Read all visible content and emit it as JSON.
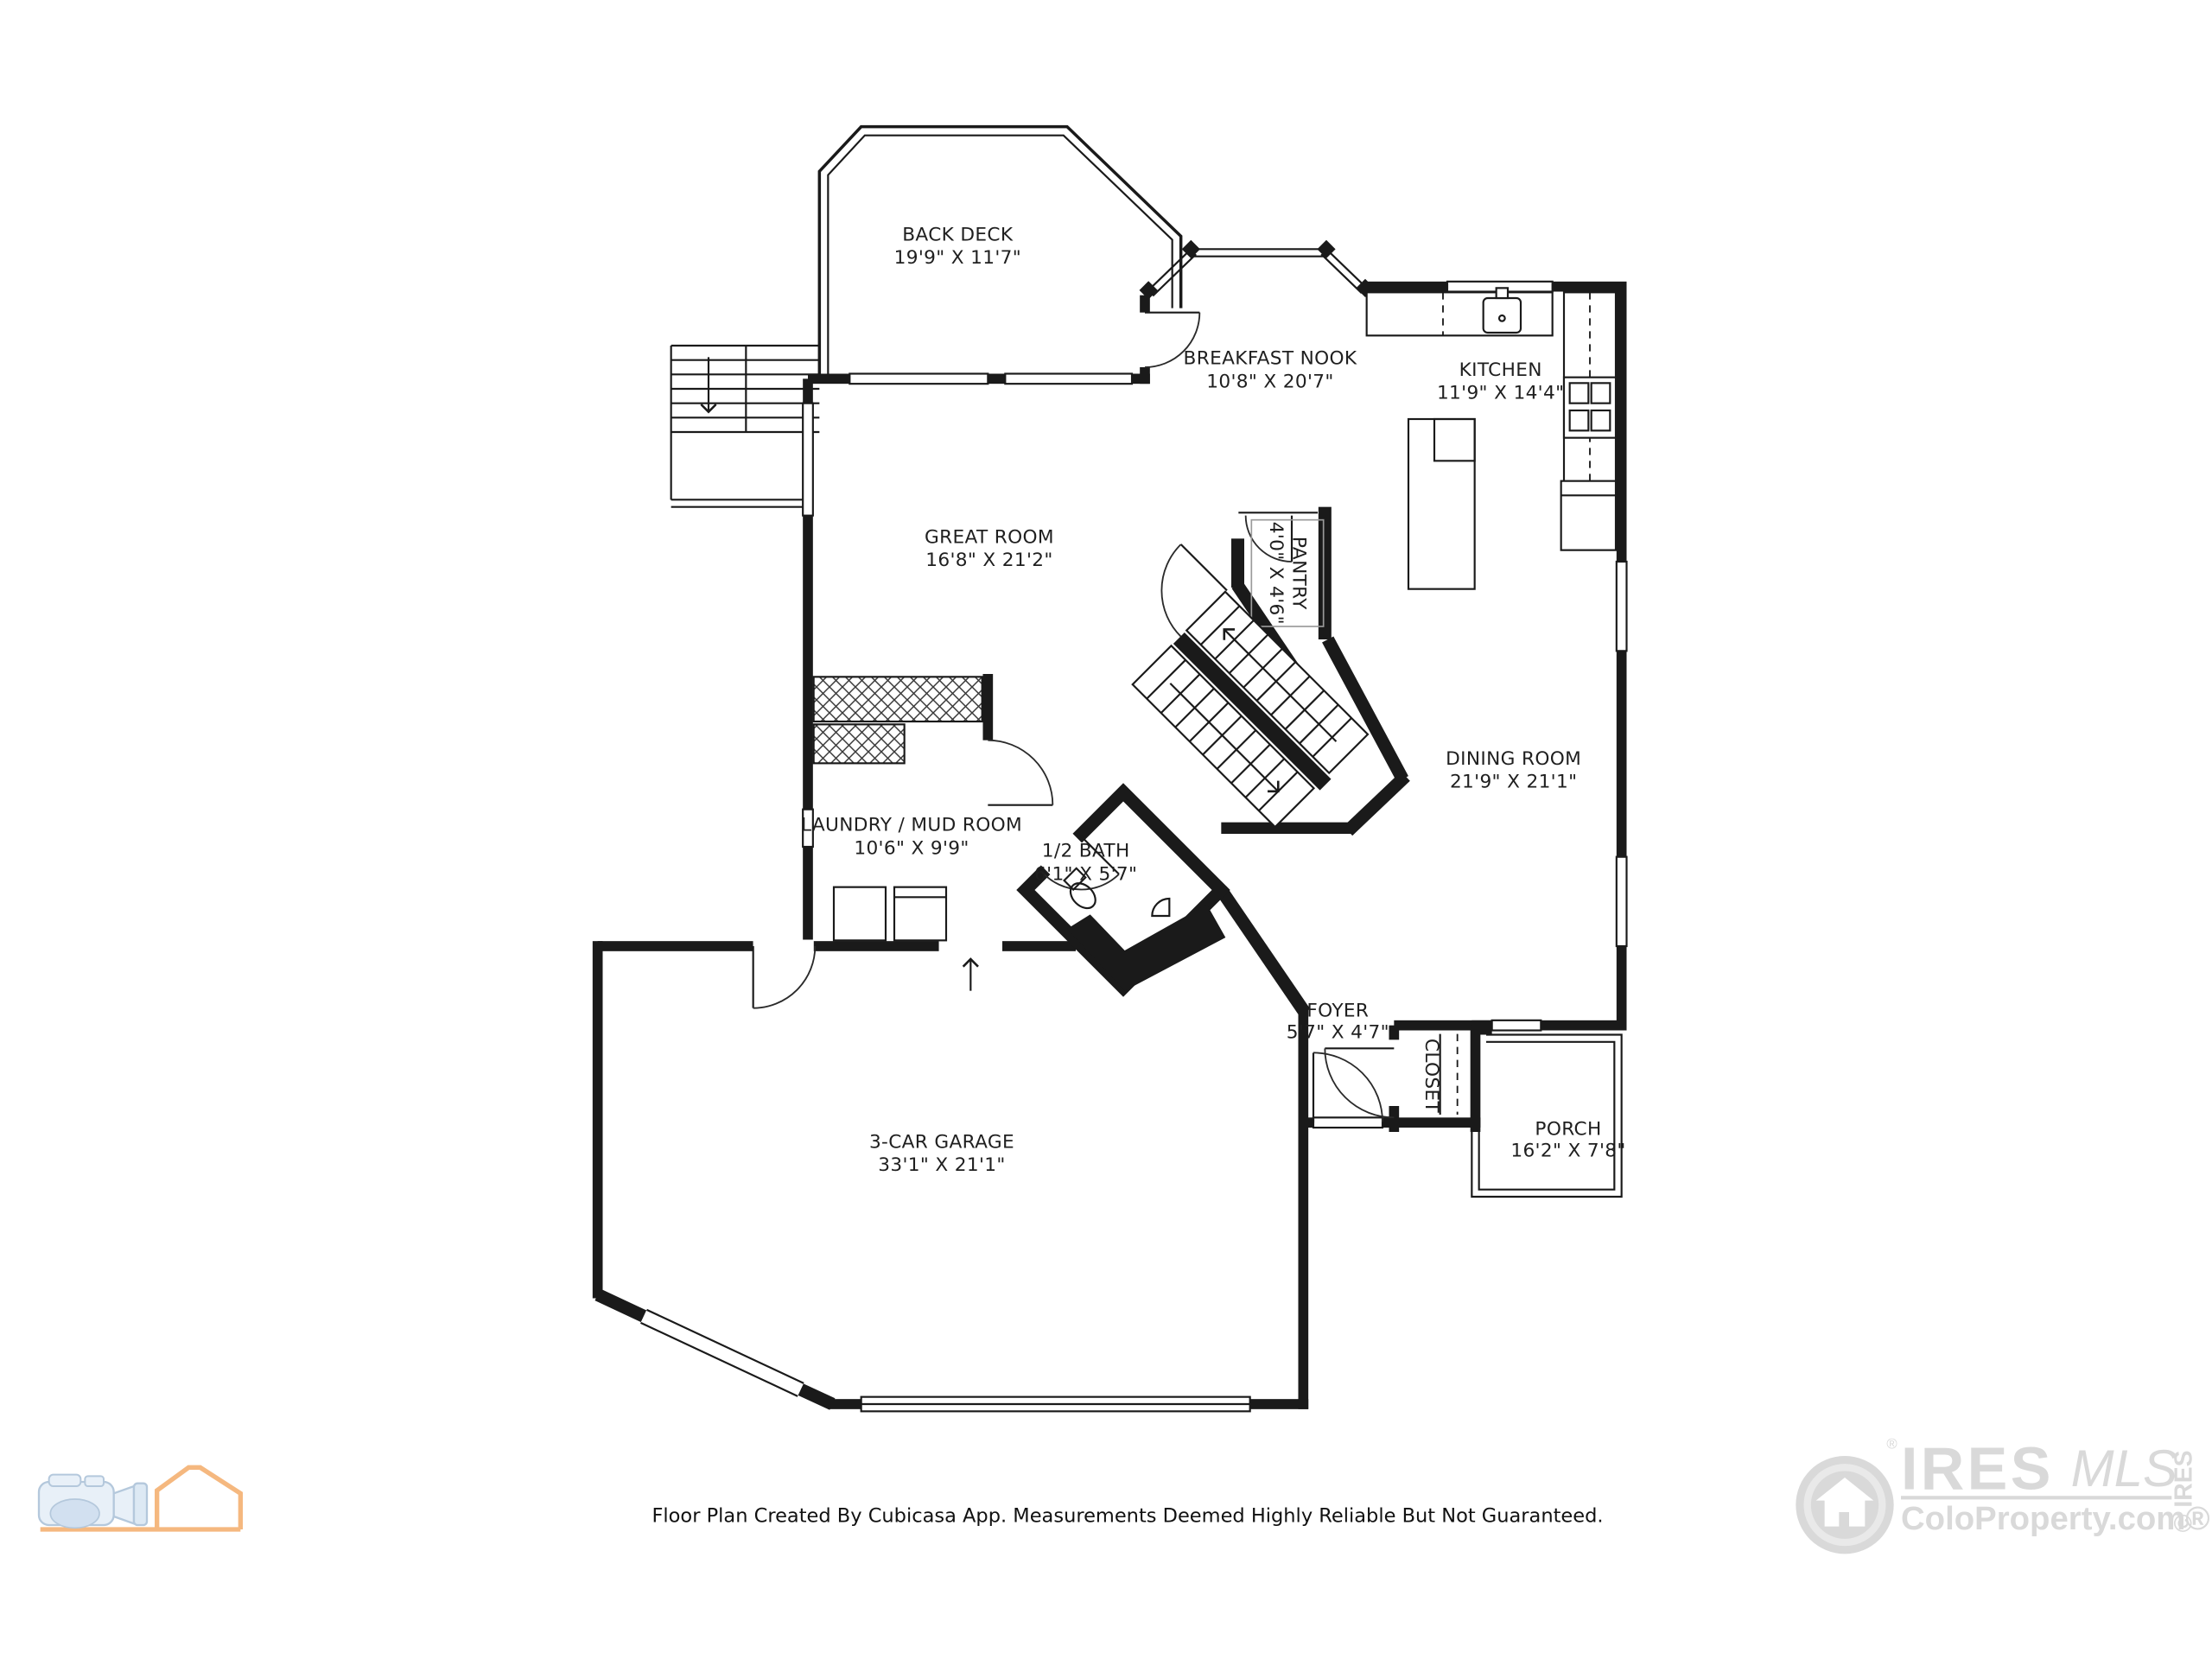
{
  "rooms": [
    {
      "id": "back-deck",
      "name": "BACK DECK",
      "dims": "19'9\" X 11'7\""
    },
    {
      "id": "breakfast-nook",
      "name": "BREAKFAST NOOK",
      "dims": "10'8\" X 20'7\""
    },
    {
      "id": "kitchen",
      "name": "KITCHEN",
      "dims": "11'9\" X 14'4\""
    },
    {
      "id": "great-room",
      "name": "GREAT ROOM",
      "dims": "16'8\" X 21'2\""
    },
    {
      "id": "pantry",
      "name": "PANTRY",
      "dims": "4'0\" X 4'6\""
    },
    {
      "id": "dining-room",
      "name": "DINING ROOM",
      "dims": "21'9\" X 21'1\""
    },
    {
      "id": "laundry",
      "name": "LAUNDRY / MUD ROOM",
      "dims": "10'6\" X 9'9\""
    },
    {
      "id": "half-bath",
      "name": "1/2 BATH",
      "dims": "6'1\" X 5'7\""
    },
    {
      "id": "foyer",
      "name": "FOYER",
      "dims": "5'7\" X 4'7\""
    },
    {
      "id": "closet",
      "name": "CLOSET",
      "dims": ""
    },
    {
      "id": "porch",
      "name": "PORCH",
      "dims": "16'2\" X 7'8\""
    },
    {
      "id": "garage",
      "name": "3-CAR GARAGE",
      "dims": "33'1\" X 21'1\""
    }
  ],
  "footer": {
    "disclaimer": "Floor Plan Created By Cubicasa App. Measurements Deemed Highly Reliable But Not Guaranteed."
  },
  "ires_logo": {
    "brand": "IRES",
    "script": "MLS",
    "site": "ColoProperty.com®",
    "vertical": "© IRES",
    "registered": "®",
    "color": "#d9d9d9"
  },
  "cubicasa_logo": {
    "house_color": "#f5b87f",
    "camera_color": "#e8f0f8"
  }
}
